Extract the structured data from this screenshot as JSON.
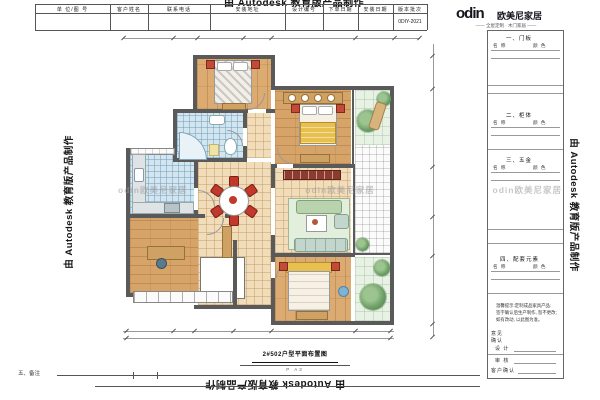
{
  "watermark": {
    "text": "由 Autodesk 教育版产品制作"
  },
  "header": {
    "columns": [
      "单 位/图 号",
      "客户姓名",
      "联系电话",
      "安装地址",
      "设计编号",
      "下单日期",
      "安装日期",
      "版本批次"
    ],
    "version_value": "0DIY-2021"
  },
  "brand": {
    "logo_text": "odin",
    "name": "欧美尼家居",
    "tagline": "—— 全屋定制 · 木门家居 ——"
  },
  "sidebar": {
    "sections": [
      {
        "title": "一、门板",
        "col1": "名 称",
        "col2": "颜 色"
      },
      {
        "title": "二、柜体",
        "col1": "名 称",
        "col2": "颜 色"
      },
      {
        "title": "三、五金",
        "col1": "名 称",
        "col2": "颜 色"
      },
      {
        "title": "四、配套元素",
        "col1": "名 称",
        "col2": "颜 色"
      }
    ],
    "notes": [
      "温馨提示:定制成品家具产品:",
      "签字确认后生产制作, 恕不更改;",
      "如有改动, 以此图为准。"
    ],
    "sign": {
      "opinion": "意见",
      "confirm": "确认",
      "design": "设 计",
      "audit": "审 核",
      "customer": "客户确认"
    }
  },
  "plan": {
    "caption": "2#502户型平面布置图",
    "caption_sub": "P A3",
    "plan_watermark": "odin欧美尼家居"
  },
  "footer": {
    "label": "五、备注"
  },
  "palette": {
    "wall": "#5a5a5a",
    "wood": "#dcab72",
    "tile": "#f2ddbb",
    "blue_tile": "#d3e5ef",
    "garden": "#e7f1e4",
    "chair_red": "#c0392b",
    "sofa_green": "#b9d3ae",
    "brand_dark": "#1a1a1a"
  }
}
